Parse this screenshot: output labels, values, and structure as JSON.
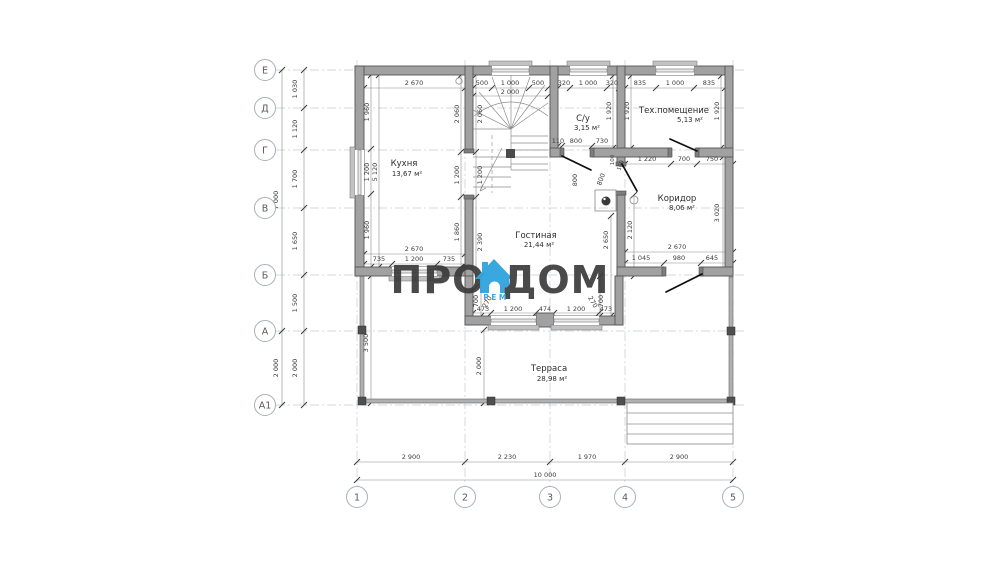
{
  "logo": {
    "pro": "ПРО",
    "dom": "ДОМ",
    "rem": "РЕМ"
  },
  "colors": {
    "wall_fill": "#a1a1a1",
    "wall_stroke": "#565656",
    "logo_blue": "#2ba0dd",
    "logo_gray": "#3b3b3b",
    "grid": "#c4ccd3",
    "dim_text": "#3c3c3c",
    "background": "#ffffff"
  },
  "rooms": [
    {
      "name": "Кухня",
      "area": "13,67 м²",
      "nx": 404,
      "ny": 166,
      "ax": 407,
      "ay": 176
    },
    {
      "name": "Гостиная",
      "area": "21,44 м²",
      "nx": 536,
      "ny": 238,
      "ax": 539,
      "ay": 247
    },
    {
      "name": "С/у",
      "area": "3,15 м²",
      "nx": 583,
      "ny": 121,
      "ax": 587,
      "ay": 130
    },
    {
      "name": "Тех.помещение",
      "area": "5,13 м²",
      "nx": 674,
      "ny": 113,
      "ax": 690,
      "ay": 122
    },
    {
      "name": "Коридор",
      "area": "8,06 м²",
      "nx": 677,
      "ny": 201,
      "ax": 682,
      "ay": 210
    },
    {
      "name": "Терраса",
      "area": "28,98 м²",
      "nx": 549,
      "ny": 371,
      "ax": 552,
      "ay": 381
    }
  ],
  "axes": {
    "left": [
      {
        "label": "Е",
        "y": 70
      },
      {
        "label": "Д",
        "y": 108
      },
      {
        "label": "Г",
        "y": 150
      },
      {
        "label": "В",
        "y": 208
      },
      {
        "label": "Б",
        "y": 275
      },
      {
        "label": "А",
        "y": 331
      },
      {
        "label": "А1",
        "y": 405
      }
    ],
    "bottom": [
      {
        "label": "1",
        "x": 357
      },
      {
        "label": "2",
        "x": 465
      },
      {
        "label": "3",
        "x": 550
      },
      {
        "label": "4",
        "x": 625
      },
      {
        "label": "5",
        "x": 733
      }
    ]
  },
  "dims": [
    {
      "t": "7 000",
      "x": 278,
      "y": 200,
      "r": -90
    },
    {
      "t": "2 000",
      "x": 278,
      "y": 368,
      "r": -90
    },
    {
      "t": "1 030",
      "x": 297,
      "y": 89,
      "r": -90
    },
    {
      "t": "1 120",
      "x": 297,
      "y": 129,
      "r": -90
    },
    {
      "t": "1 700",
      "x": 297,
      "y": 179,
      "r": -90
    },
    {
      "t": "1 650",
      "x": 297,
      "y": 241,
      "r": -90
    },
    {
      "t": "1 500",
      "x": 297,
      "y": 303,
      "r": -90
    },
    {
      "t": "2 000",
      "x": 297,
      "y": 368,
      "r": -90
    },
    {
      "t": "2 900",
      "x": 411,
      "y": 459
    },
    {
      "t": "2 230",
      "x": 507,
      "y": 459
    },
    {
      "t": "1 970",
      "x": 587,
      "y": 459
    },
    {
      "t": "2 900",
      "x": 679,
      "y": 459
    },
    {
      "t": "10 000",
      "x": 545,
      "y": 477
    },
    {
      "t": "2 670",
      "x": 414,
      "y": 85
    },
    {
      "t": "500",
      "x": 482,
      "y": 85
    },
    {
      "t": "1 000",
      "x": 510,
      "y": 85
    },
    {
      "t": "500",
      "x": 538,
      "y": 85
    },
    {
      "t": "2 000",
      "x": 510,
      "y": 94
    },
    {
      "t": "320",
      "x": 564,
      "y": 85
    },
    {
      "t": "1 000",
      "x": 588,
      "y": 85
    },
    {
      "t": "320",
      "x": 612,
      "y": 85
    },
    {
      "t": "835",
      "x": 640,
      "y": 85
    },
    {
      "t": "1 000",
      "x": 675,
      "y": 85
    },
    {
      "t": "835",
      "x": 709,
      "y": 85
    },
    {
      "t": "1 960",
      "x": 369,
      "y": 112,
      "r": -90
    },
    {
      "t": "1 200",
      "x": 369,
      "y": 172,
      "r": -90
    },
    {
      "t": "1 960",
      "x": 369,
      "y": 230,
      "r": -90
    },
    {
      "t": "5 120",
      "x": 377,
      "y": 172,
      "r": -90
    },
    {
      "t": "2 060",
      "x": 459,
      "y": 114,
      "r": -90
    },
    {
      "t": "1 200",
      "x": 459,
      "y": 175,
      "r": -90
    },
    {
      "t": "1 860",
      "x": 459,
      "y": 232,
      "r": -90
    },
    {
      "t": "2 060",
      "x": 482,
      "y": 114,
      "r": -90
    },
    {
      "t": "1 200",
      "x": 482,
      "y": 175,
      "r": -90
    },
    {
      "t": "2 390",
      "x": 482,
      "y": 242,
      "r": -90
    },
    {
      "t": "1 920",
      "x": 611,
      "y": 111,
      "r": -90
    },
    {
      "t": "1 920",
      "x": 629,
      "y": 111,
      "r": -90
    },
    {
      "t": "1 920",
      "x": 719,
      "y": 111,
      "r": -90
    },
    {
      "t": "110",
      "x": 558,
      "y": 143
    },
    {
      "t": "800",
      "x": 576,
      "y": 143
    },
    {
      "t": "730",
      "x": 602,
      "y": 143
    },
    {
      "t": "1 220",
      "x": 647,
      "y": 161
    },
    {
      "t": "700",
      "x": 684,
      "y": 161
    },
    {
      "t": "750",
      "x": 712,
      "y": 161
    },
    {
      "t": "800",
      "x": 577,
      "y": 180,
      "r": -90
    },
    {
      "t": "800",
      "x": 603,
      "y": 180,
      "r": -70
    },
    {
      "t": "100",
      "x": 614,
      "y": 160,
      "r": -90,
      "s": 1
    },
    {
      "t": "100",
      "x": 622,
      "y": 166,
      "r": -70,
      "s": 1
    },
    {
      "t": "3 020",
      "x": 719,
      "y": 213,
      "r": -90
    },
    {
      "t": "2 120",
      "x": 632,
      "y": 230,
      "r": -90
    },
    {
      "t": "2 650",
      "x": 608,
      "y": 240,
      "r": -90
    },
    {
      "t": "2 670",
      "x": 677,
      "y": 249
    },
    {
      "t": "1 045",
      "x": 641,
      "y": 260
    },
    {
      "t": "980",
      "x": 679,
      "y": 260
    },
    {
      "t": "645",
      "x": 712,
      "y": 260
    },
    {
      "t": "2 670",
      "x": 414,
      "y": 251
    },
    {
      "t": "735",
      "x": 379,
      "y": 261
    },
    {
      "t": "1 200",
      "x": 414,
      "y": 261
    },
    {
      "t": "735",
      "x": 449,
      "y": 261
    },
    {
      "t": "700",
      "x": 478,
      "y": 301,
      "r": -90
    },
    {
      "t": "270",
      "x": 489,
      "y": 303,
      "r": -60
    },
    {
      "t": "270",
      "x": 591,
      "y": 303,
      "r": 60
    },
    {
      "t": "700",
      "x": 603,
      "y": 301,
      "r": -90
    },
    {
      "t": "473",
      "x": 483,
      "y": 311
    },
    {
      "t": "1 200",
      "x": 513,
      "y": 311
    },
    {
      "t": "474",
      "x": 545,
      "y": 311
    },
    {
      "t": "1 200",
      "x": 576,
      "y": 311
    },
    {
      "t": "473",
      "x": 606,
      "y": 311
    },
    {
      "t": "3 500",
      "x": 368,
      "y": 343,
      "r": -90
    },
    {
      "t": "2 000",
      "x": 481,
      "y": 366,
      "r": -90
    }
  ]
}
